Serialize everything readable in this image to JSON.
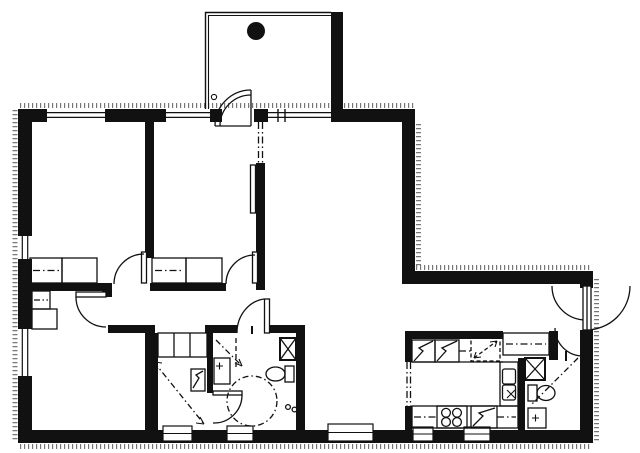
{
  "meta": {
    "type": "architectural-floor-plan",
    "description": "Black-and-white line drawing of an apartment floor plan with a balcony at top, three bedrooms on the left, an open living/dining area on the right, and a service block with sauna, bathroom, kitchen, WC and entry hall at the bottom",
    "width_px": 640,
    "height_px": 453
  },
  "colors": {
    "ink": "#111111",
    "paper": "#ffffff",
    "hatch": "#777777"
  },
  "rooms": [
    {
      "id": "balcony",
      "name": "Balcony",
      "fixtures": [
        "round-table",
        "balcony-door"
      ]
    },
    {
      "id": "bedroom-1",
      "name": "Bedroom 1",
      "fixtures": [
        "wardrobe",
        "wardrobe",
        "window"
      ]
    },
    {
      "id": "bedroom-2",
      "name": "Bedroom 2",
      "fixtures": [
        "wardrobe",
        "wardrobe",
        "sliding-partition",
        "window"
      ]
    },
    {
      "id": "living-room",
      "name": "Living room",
      "fixtures": []
    },
    {
      "id": "bedroom-3",
      "name": "Bedroom 3",
      "fixtures": [
        "wardrobe",
        "wardrobe",
        "window"
      ]
    },
    {
      "id": "hall",
      "name": "Hall",
      "fixtures": [
        "closet",
        "closet",
        "closet"
      ]
    },
    {
      "id": "sauna",
      "name": "Sauna",
      "fixtures": [
        "sauna-heater"
      ]
    },
    {
      "id": "bathroom",
      "name": "Bathroom",
      "fixtures": [
        "washbasin",
        "toilet",
        "shower-mixer",
        "vent-shaft",
        "turning-circle"
      ]
    },
    {
      "id": "dining",
      "name": "Dining area",
      "fixtures": [
        "window"
      ]
    },
    {
      "id": "kitchen",
      "name": "Kitchen",
      "fixtures": [
        "refrigerator",
        "freezer",
        "upper-cabinet",
        "double-sink",
        "stove",
        "appliance-reservation",
        "counter"
      ]
    },
    {
      "id": "wc",
      "name": "WC",
      "fixtures": [
        "toilet",
        "washbasin",
        "vent-shaft"
      ]
    },
    {
      "id": "entry",
      "name": "Entry",
      "fixtures": [
        "closet",
        "entrance-door"
      ]
    }
  ],
  "openings": {
    "window_count": 12,
    "doors": [
      "balcony-door",
      "bedroom-1-door",
      "bedroom-2-door",
      "bedroom-3-door",
      "bathroom-door",
      "sauna-bathroom-door",
      "wc-door",
      "entrance-door"
    ]
  }
}
